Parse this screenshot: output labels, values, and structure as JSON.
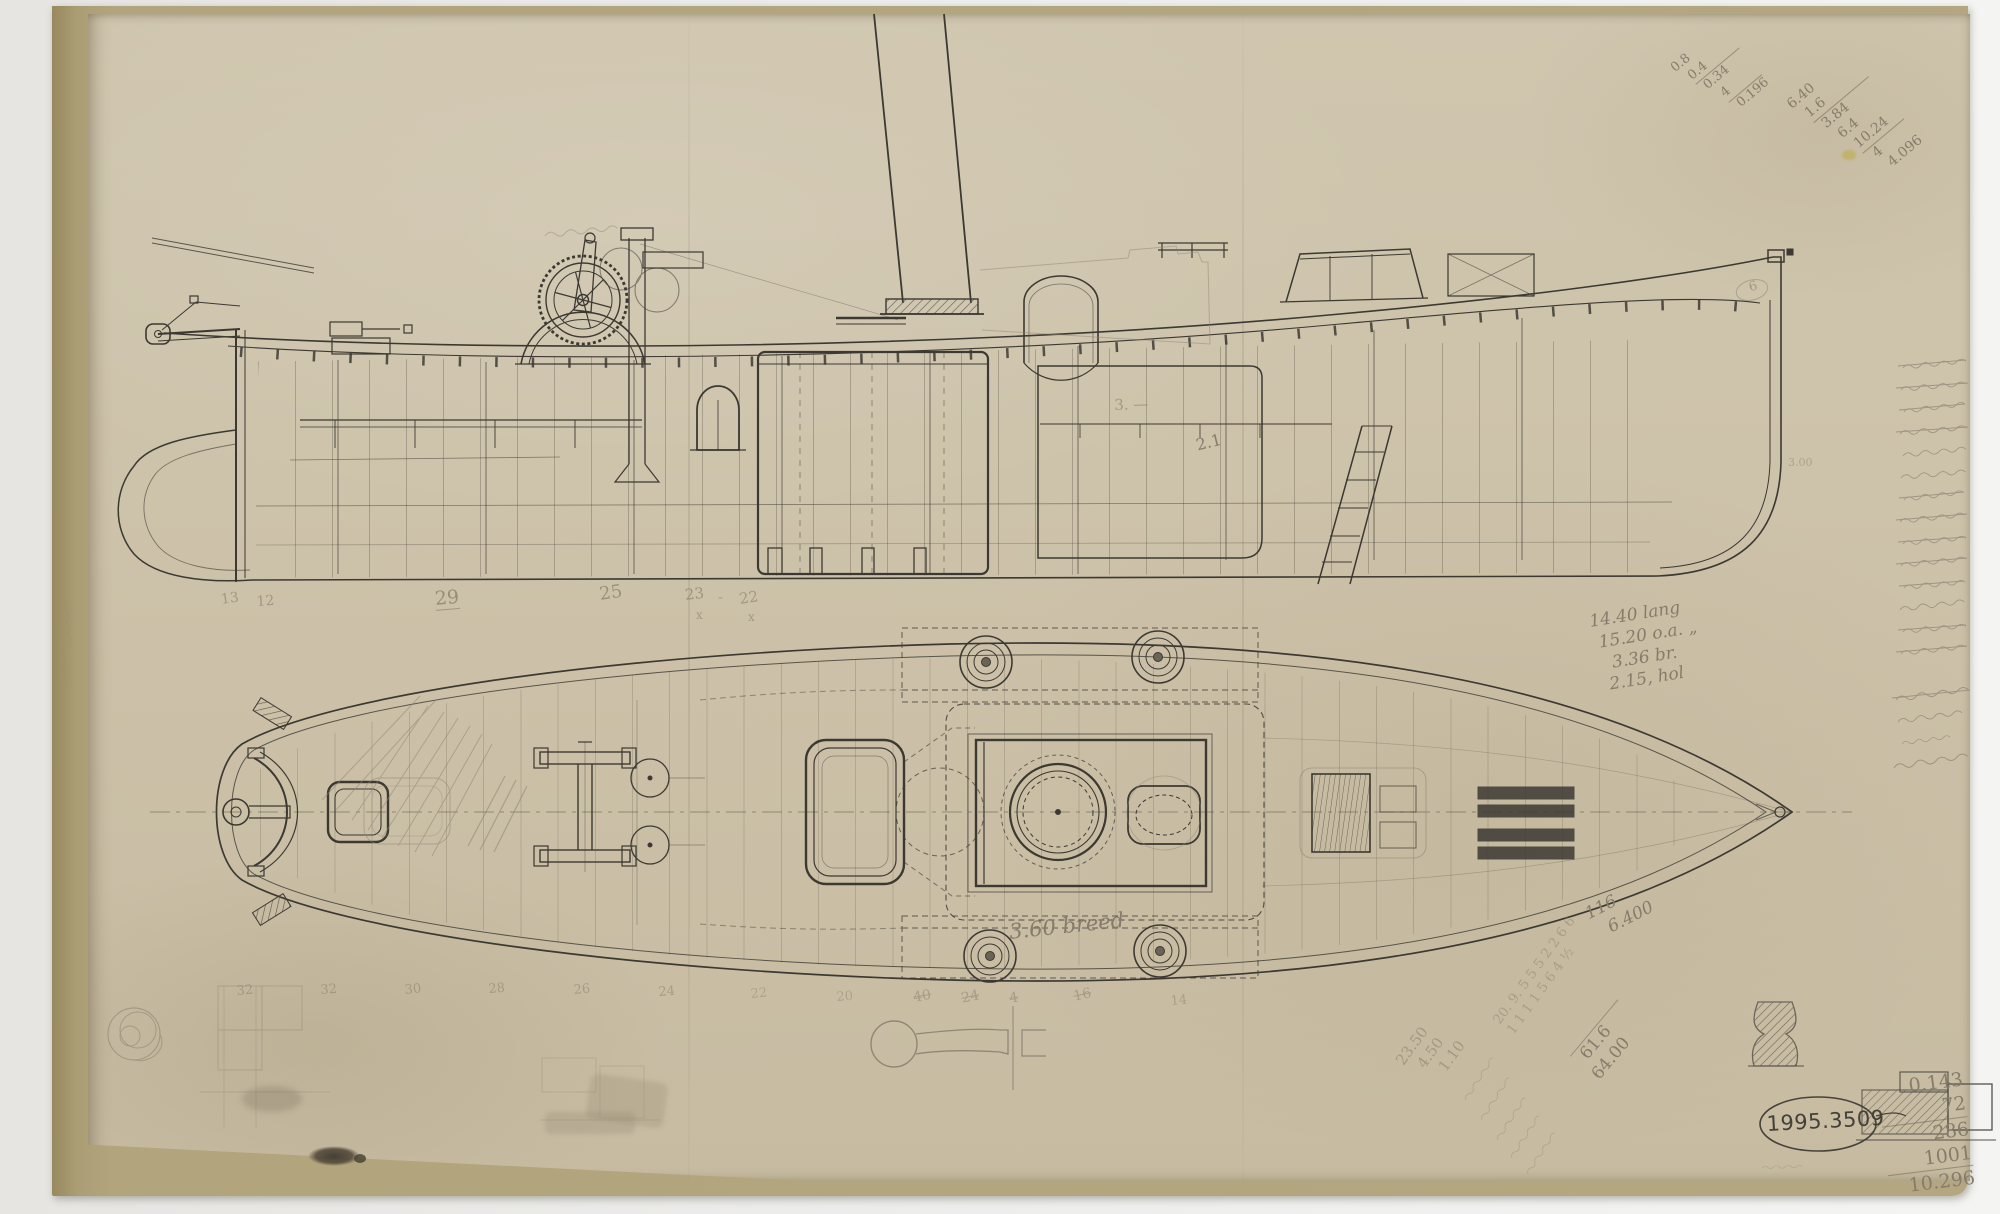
{
  "drawing": {
    "accession_number": "1995.3509",
    "notes": {
      "dimension": [
        "14.40 lang",
        "15.20 o.a. „",
        "3.36 br.",
        "2.15, hol"
      ],
      "breadth": "3.60 breed",
      "displacement": [
        "116",
        "6.400"
      ],
      "sum": [
        "61.6",
        "64.00"
      ],
      "costs": [
        "23.50",
        "4.50",
        "1.10"
      ],
      "tally": [
        "20. 9. 5 5 5 2 2 6 6",
        "1 1 1 1 5 6 4 ½"
      ],
      "calc_a": [
        "0.8",
        "0.4",
        "0.34",
        "4",
        "0.196"
      ],
      "calc_b": [
        "6.40",
        "1.6",
        "3.84",
        "6.4",
        "10.24",
        "4",
        "4.096"
      ],
      "calc_c": [
        "0.143",
        "72",
        "286",
        "1001",
        "10.296"
      ],
      "depth_mark": "2.1",
      "length_mark": "3. —",
      "bow_mark": "6",
      "stem_dim": "3.00"
    },
    "stations_side": [
      "13",
      "12",
      "29",
      "25",
      "23",
      "-",
      "22",
      "x",
      "x"
    ],
    "stations_plan": [
      "32",
      "32",
      "30",
      "28",
      "26",
      "24",
      "22",
      "20",
      "40",
      "24",
      "4",
      "16",
      "14"
    ]
  }
}
